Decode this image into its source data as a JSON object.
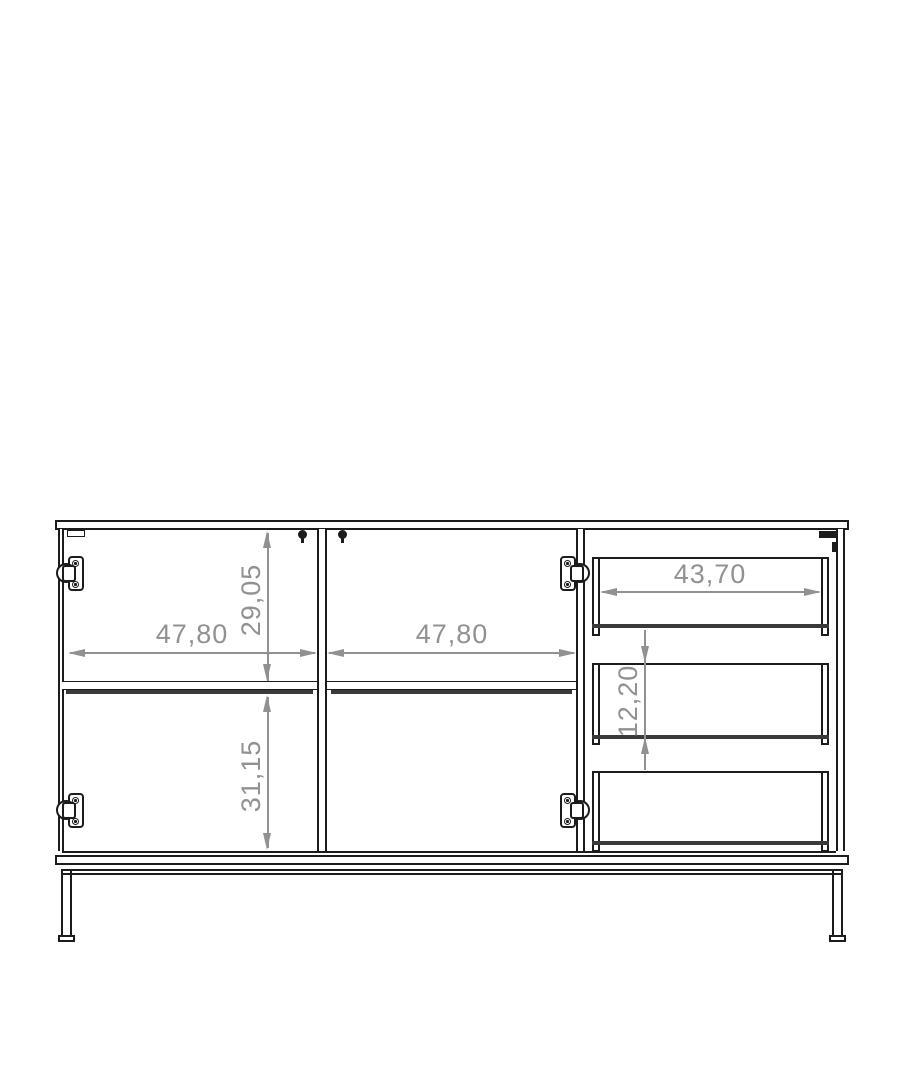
{
  "drawing": {
    "background": "#ffffff",
    "colors": {
      "outline": "#1c1c1c",
      "drawer_bottom_accent": "#3a3a3a",
      "dimension": "#919191"
    },
    "dimensions": {
      "left_door_width": "47,80",
      "right_door_width": "47,80",
      "upper_compartment_height": "29,05",
      "lower_compartment_height": "31,15",
      "drawer_width": "43,70",
      "drawer_front_height": "12,20"
    }
  }
}
